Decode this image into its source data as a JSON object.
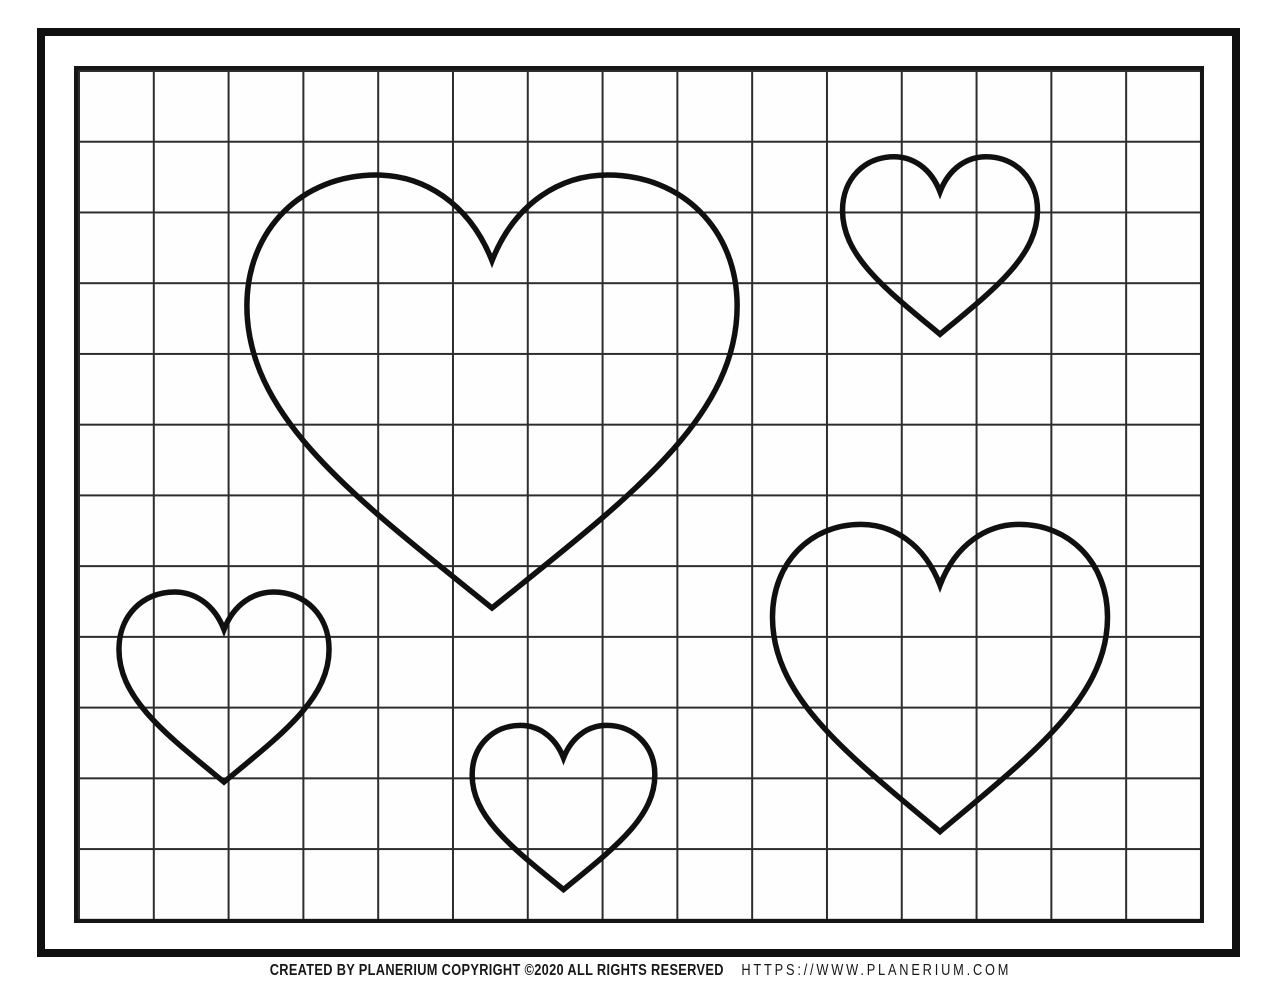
{
  "page": {
    "background": "#ffffff",
    "ink_color": "#101010",
    "grid_line_color": "#2d2d2d"
  },
  "grid": {
    "columns": 15,
    "rows": 12
  },
  "hearts": [
    {
      "name": "heart-large-center",
      "x": 233,
      "y": 166,
      "width": 518,
      "height": 451
    },
    {
      "name": "heart-top-right",
      "x": 837,
      "y": 153,
      "width": 206,
      "height": 185
    },
    {
      "name": "heart-left",
      "x": 113,
      "y": 588,
      "width": 222,
      "height": 198
    },
    {
      "name": "heart-bottom-center",
      "x": 467,
      "y": 722,
      "width": 193,
      "height": 171
    },
    {
      "name": "heart-right",
      "x": 763,
      "y": 518,
      "width": 354,
      "height": 320
    }
  ],
  "footer": {
    "credit": "CREATED BY PLANERIUM COPYRIGHT ©2020 ALL RIGHTS RESERVED",
    "url": "HTTPS://WWW.PLANERIUM.COM"
  }
}
